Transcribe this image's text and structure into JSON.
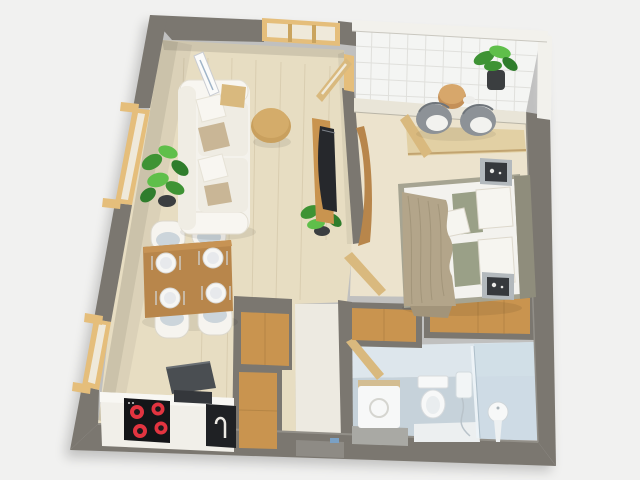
{
  "scene": {
    "type": "3d-floorplan-render",
    "description": "Top-down 3D render of a one-bedroom apartment floor plan on a light gray background",
    "rooms": [
      {
        "name": "living-room",
        "items": [
          "white-sofa",
          "throw-pillows",
          "leaning-floor-lamp",
          "armrest-tray",
          "round-coffee-table",
          "tv-media-panel",
          "potted-plant",
          "dining-table",
          "four-dining-chairs",
          "four-place-settings"
        ]
      },
      {
        "name": "kitchen",
        "items": [
          "white-counter",
          "induction-cooktop",
          "four-red-burners",
          "dark-sink",
          "open-appliance-lid",
          "built-in-oven",
          "faucet",
          "tall-wood-cabinets"
        ]
      },
      {
        "name": "bedroom",
        "items": [
          "double-bed",
          "taupe-throw-blanket",
          "white-pillows",
          "sage-pillows",
          "headboard",
          "two-nightstands",
          "two-speakers",
          "wall-desk",
          "curved-wood-panel",
          "wardrobe"
        ]
      },
      {
        "name": "balcony",
        "items": [
          "two-wicker-chairs",
          "round-side-table",
          "potted-plant",
          "white-tile-floor"
        ]
      },
      {
        "name": "bathroom",
        "items": [
          "washing-machine",
          "toilet",
          "pedestal-sink",
          "glass-shower-screen",
          "shower-set",
          "gray-bath-mat",
          "shower-platform"
        ]
      },
      {
        "name": "hallway",
        "items": [
          "wood-closet-top",
          "entry-area"
        ]
      }
    ],
    "openings": [
      "left-wall-window-upper",
      "left-wall-window-lower",
      "top-wall-window",
      "living-balcony-door",
      "bedroom-balcony-door",
      "bedroom-door",
      "bathroom-door"
    ]
  },
  "palette": {
    "background": "#f1f1f0",
    "wall": "#7b7770",
    "wallWhite": "#f2f1ec",
    "floorWood": "#e7ddc2",
    "grain": "#c9bb9c",
    "floorBedroom": "#ece3cd",
    "floorBalcony": "#f4f5f3",
    "tileLine": "#dededa",
    "floorBath": "#c6d2da",
    "bathWall": "#dde6ec",
    "floorHall": "#edeae1",
    "windowFrame": "#e5be7b",
    "glassPane": "#efe9da",
    "doorWood": "#d9b97e",
    "woodCabinet": "#c9944f",
    "woodTable": "#b8864b",
    "woodDesk": "#e2d0a4",
    "counter": "#f1efe9",
    "applianceDark": "#1f2124",
    "cooktopBlack": "#141518",
    "burnerRed": "#e23440",
    "sinkSteel": "#34373b",
    "sofa": "#f4f2ec",
    "cushion": "#efece3",
    "pillowTaupe": "#c9b696",
    "bedFrame": "#a6a492",
    "headboard": "#8f8d7c",
    "mattress": "#f3f2ee",
    "blanket": "#b3a58a",
    "blanketDark": "#a2947a",
    "pillowSage": "#9aa087",
    "nightstand": "#b3b9bd",
    "speakerDark": "#36393d",
    "plantGreen": "#3e9334",
    "plantLight": "#5fbf4a",
    "plantDark": "#2f7d2c",
    "pot": "#3b3e40",
    "wicker": "#8d9297",
    "fixtureWhite": "#f7f8f8",
    "mat": "#a9a9a4",
    "tvDark": "#26282c",
    "tableWoodTop": "#d4ac6a"
  }
}
